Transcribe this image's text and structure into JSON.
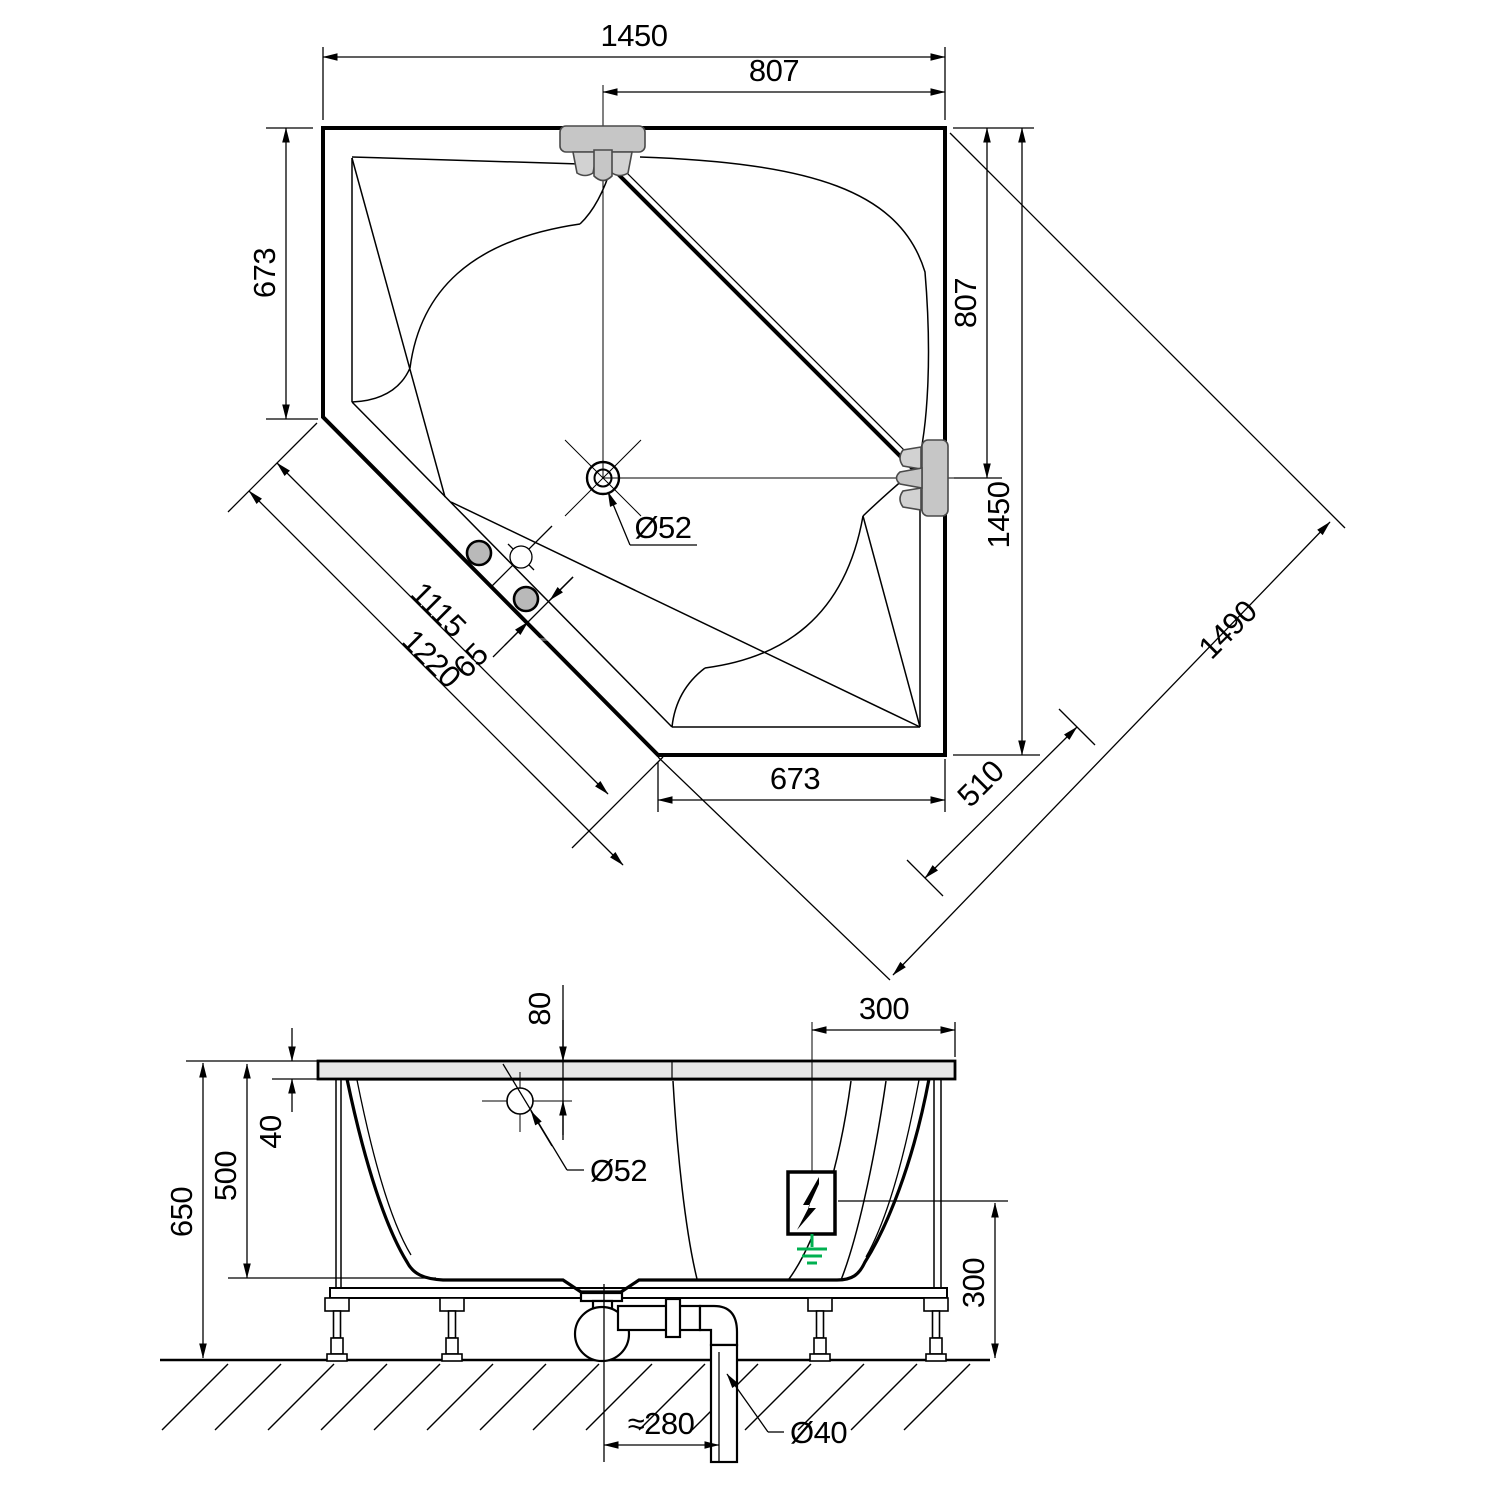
{
  "title": "corner-bathtub-technical-drawing",
  "colors": {
    "tub_fill": "#e8e8e8",
    "section_fill": "#ececec",
    "fixture_fill": "#c6c6c6",
    "line": "#000000",
    "ground_green": "#00b050"
  },
  "labels": {
    "top": {
      "overall_width": "1450",
      "faucet_offset": "807",
      "left_edge": "673",
      "right_faucet_offset": "807",
      "right_edge": "1450",
      "diag_clearance": "1490",
      "cut_edge_length": "1115",
      "cut_edge_overall": "1220",
      "rim_width": "65",
      "drain_diameter": "Ø52",
      "bottom_edge": "673",
      "corner_offset": "510"
    },
    "side": {
      "overflow_offset": "80",
      "deck_width": "300",
      "rim_height": "40",
      "inner_depth": "500",
      "total_height": "650",
      "overflow_diameter": "Ø52",
      "connection_height": "300",
      "trap_offset": "≈280",
      "pipe_diameter": "Ø40"
    }
  }
}
